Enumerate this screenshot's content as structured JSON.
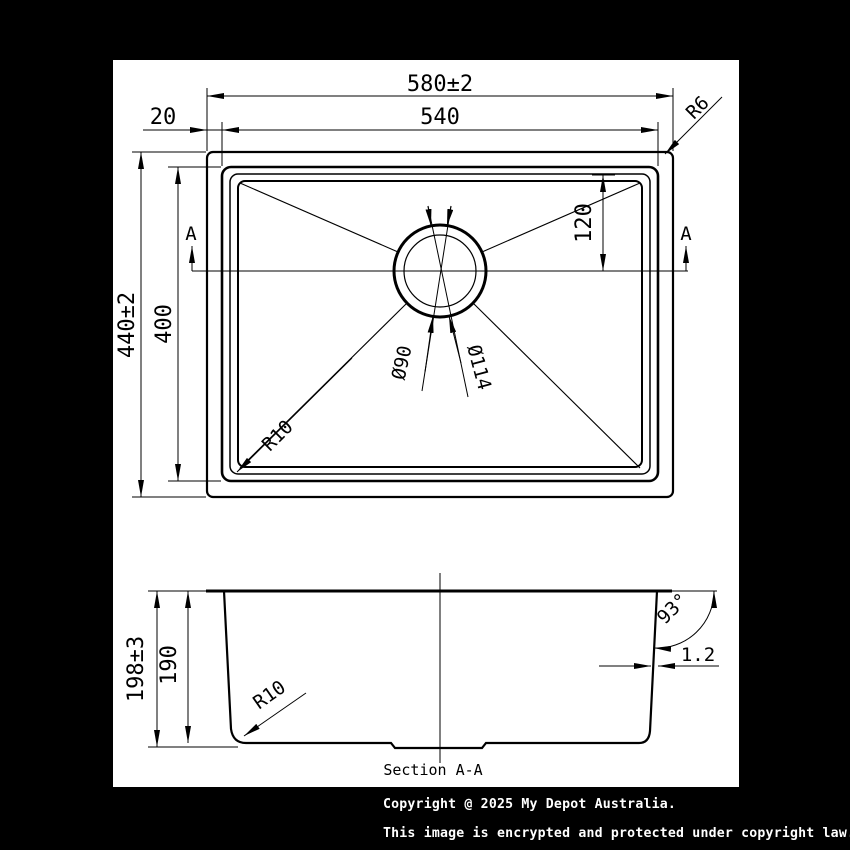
{
  "drawing": {
    "type": "technical-drawing",
    "subject": "undermount kitchen sink dimensions",
    "views": [
      "plan view",
      "Section A-A"
    ]
  },
  "top_view": {
    "dim_overall_width": "580±2",
    "dim_bowl_width": "540",
    "dim_rim_offset": "20",
    "dim_overall_depth": "440±2",
    "dim_bowl_depth": "400",
    "dim_drain_offset": "120",
    "radius_outer_corner": "R6",
    "radius_bowl_corner": "R10",
    "drain_inner_diameter": "Ø90",
    "drain_outer_diameter": "Ø114",
    "section_marker": "A"
  },
  "section_view": {
    "title": "Section A-A",
    "dim_overall_height": "198±3",
    "dim_inner_depth": "190",
    "radius_bottom_corner": "R10",
    "wall_angle": "93°",
    "wall_thickness": "1.2"
  },
  "copyright": {
    "line1": "Copyright @ 2025 My Depot Australia.",
    "line2": "This image is encrypted and protected under copyright law."
  },
  "colors": {
    "background": "#000000",
    "paper": "#ffffff",
    "ink": "#000000",
    "copyright_text": "#ffffff"
  }
}
